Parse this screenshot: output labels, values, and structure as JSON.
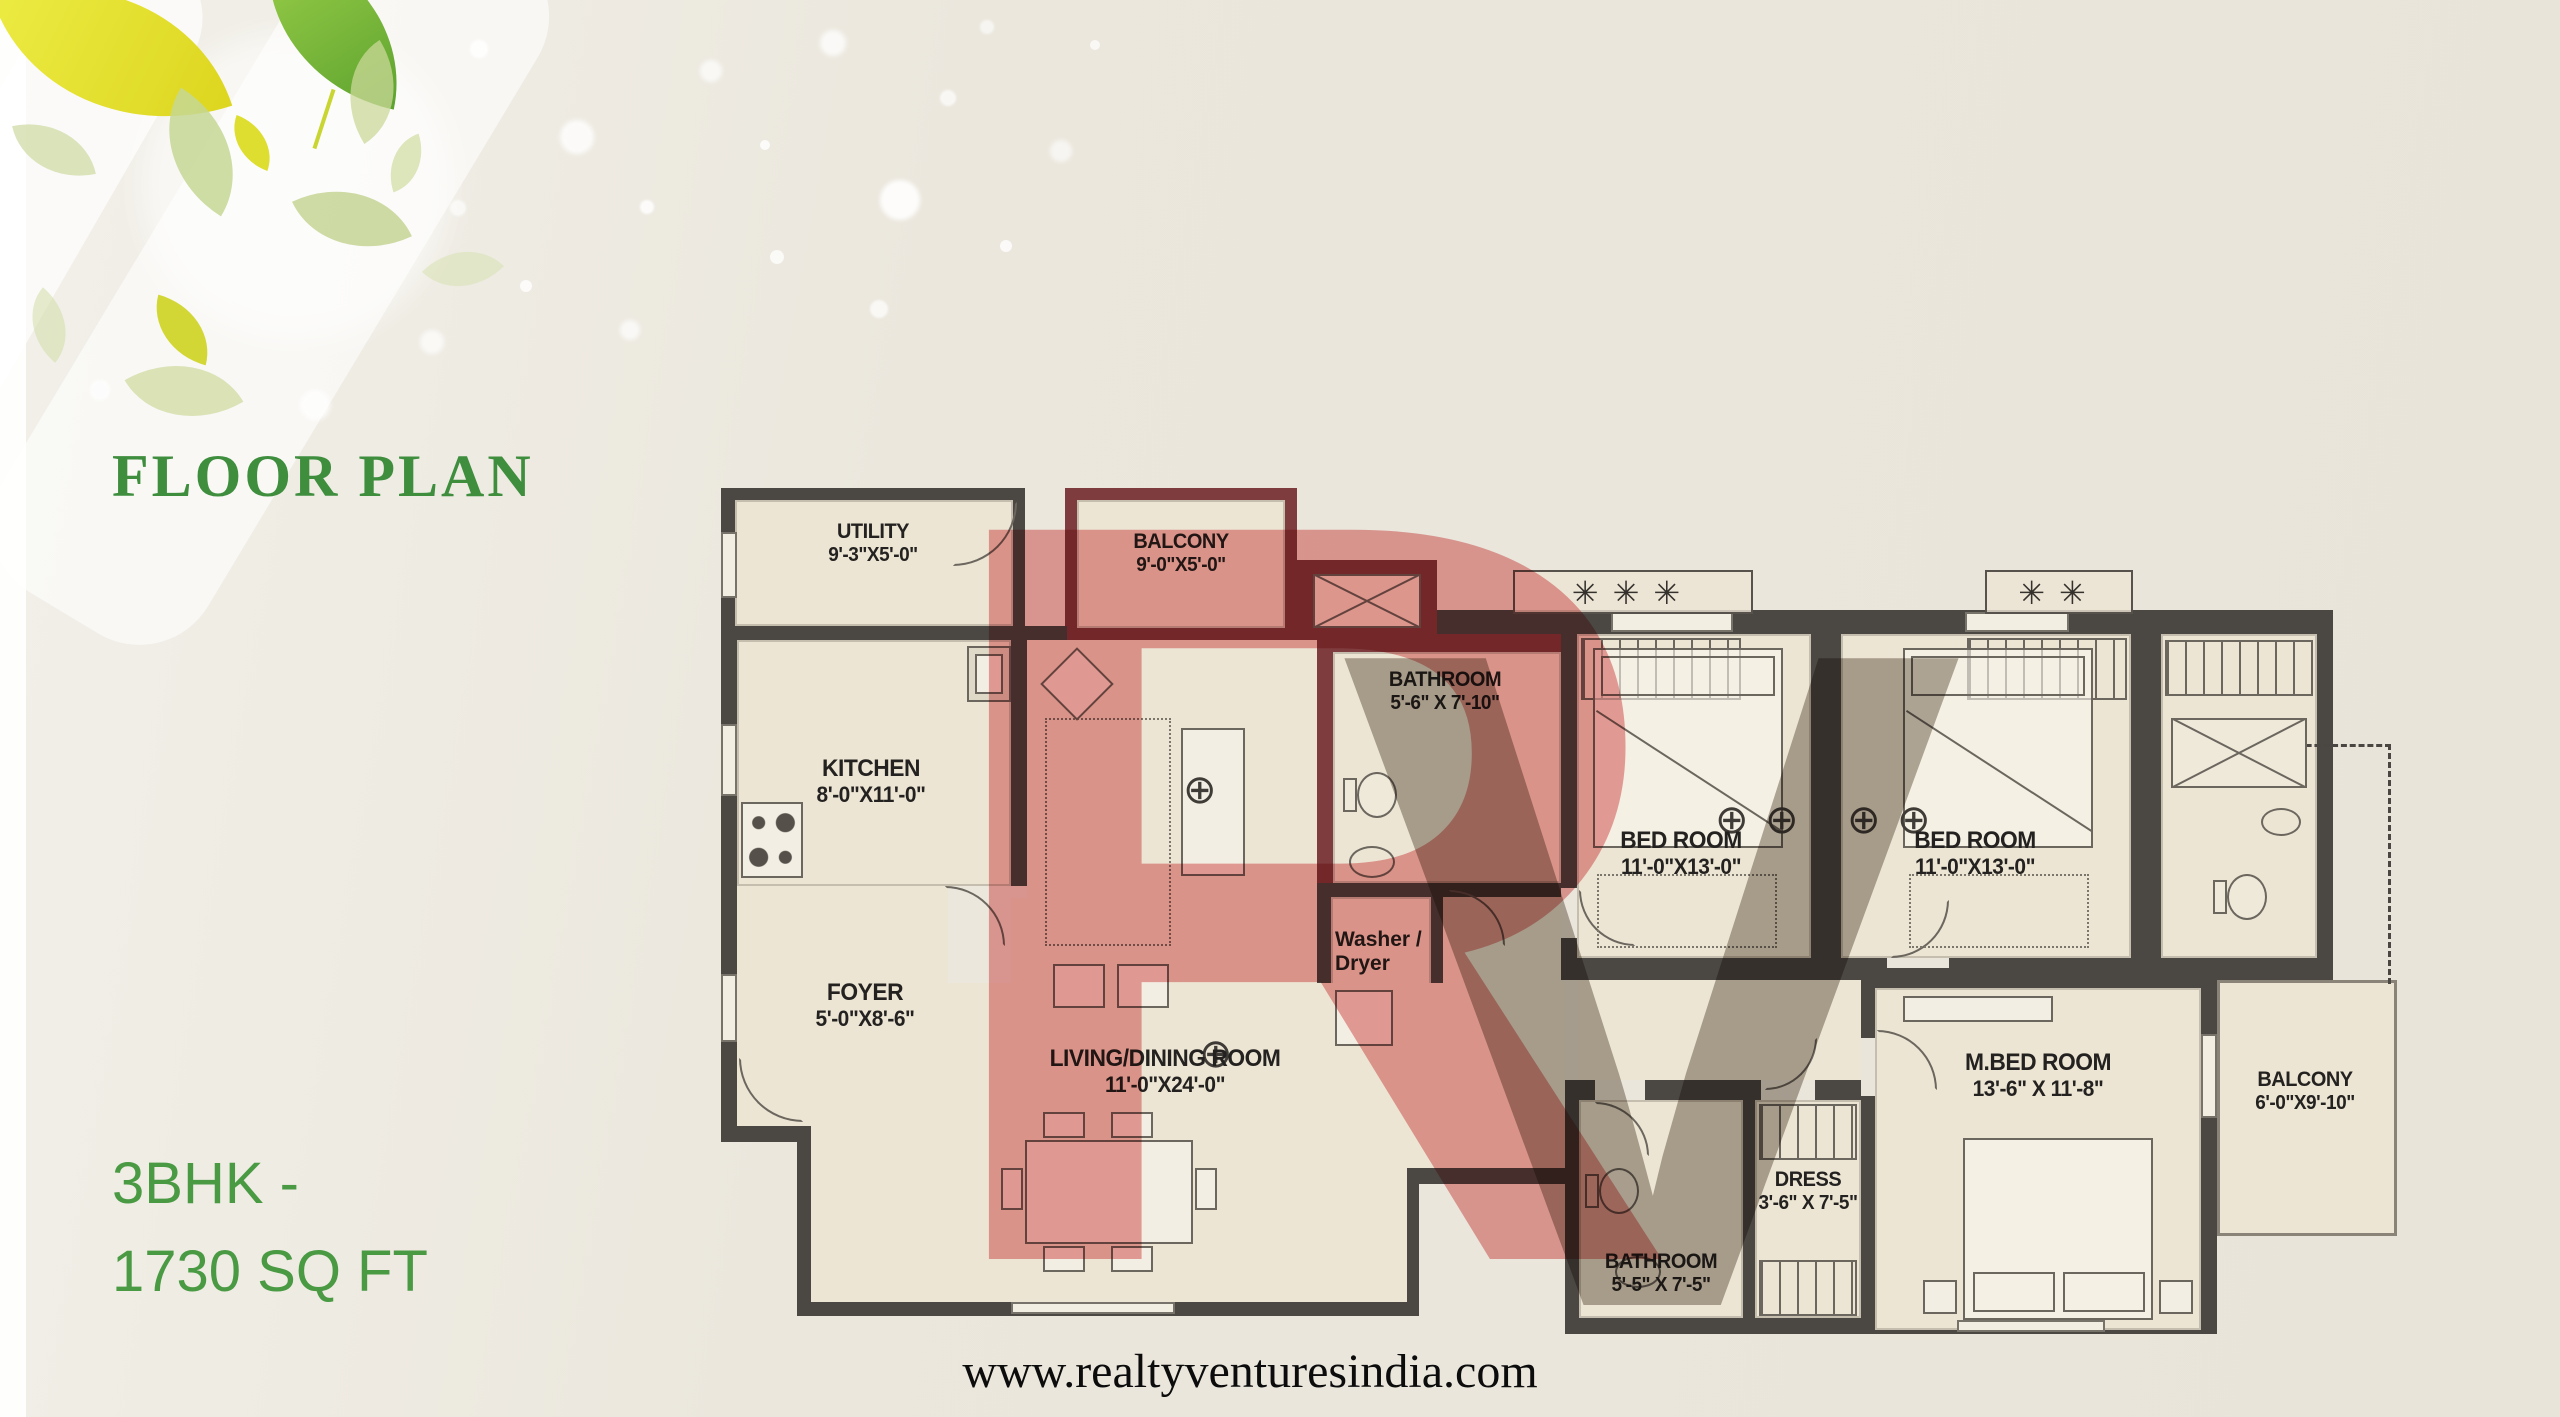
{
  "page": {
    "title": "FLOOR PLAN",
    "unit_type": "3BHK -",
    "unit_area": "1730 SQ FT",
    "website": "www.realtyventuresindia.com"
  },
  "colors": {
    "background_beige": "#e9e5da",
    "title_green": "#3e8e3e",
    "unit_green": "#4a9a43",
    "floor_cream": "#ece5d4",
    "wall_dark": "#4b4743",
    "wall_maroon": "#7e3c3e",
    "watermark_red": "#e89494",
    "watermark_gray": "#a0968c",
    "leaf_yellow": "#e6e33c",
    "leaf_green": "#8fc63f"
  },
  "icons": {
    "lamp_glyph": "⊕",
    "planter_glyph": "✳"
  },
  "watermark": {
    "r": "R",
    "v": "V"
  },
  "rooms": [
    {
      "id": "utility",
      "name": "UTILITY",
      "dims": "9'-3\"X5'-0\""
    },
    {
      "id": "balcony_top",
      "name": "BALCONY",
      "dims": "9'-0\"X5'-0\""
    },
    {
      "id": "kitchen",
      "name": "KITCHEN",
      "dims": "8'-0\"X11'-0\""
    },
    {
      "id": "bathroom_top",
      "name": "BATHROOM",
      "dims": "5'-6\" X 7'-10\""
    },
    {
      "id": "washer_dryer",
      "name": "Washer / Dryer",
      "dims": ""
    },
    {
      "id": "bedroom_1",
      "name": "BED ROOM",
      "dims": "11'-0\"X13'-0\""
    },
    {
      "id": "bedroom_2",
      "name": "BED ROOM",
      "dims": "11'-0\"X13'-0\""
    },
    {
      "id": "foyer",
      "name": "FOYER",
      "dims": "5'-0\"X8'-6\""
    },
    {
      "id": "living_dining",
      "name": "LIVING/DINING ROOM",
      "dims": "11'-0\"X24'-0\""
    },
    {
      "id": "master_bedroom",
      "name": "M.BED ROOM",
      "dims": "13'-6\" X 11'-8\""
    },
    {
      "id": "dress",
      "name": "DRESS",
      "dims": "3'-6\" X 7'-5\""
    },
    {
      "id": "bathroom_bottom",
      "name": "BATHROOM",
      "dims": "5'-5\" X 7'-5\""
    },
    {
      "id": "balcony_right",
      "name": "BALCONY",
      "dims": "6'-0\"X9'-10\""
    }
  ]
}
